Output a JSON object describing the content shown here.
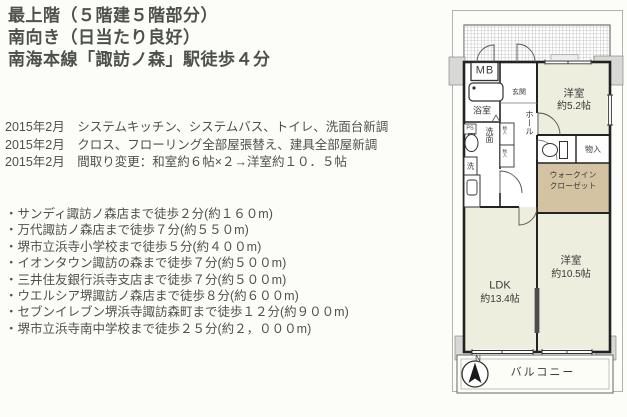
{
  "listing": {
    "headline_lines": [
      "最上階（５階建５階部分）",
      "南向き（日当たり良好）",
      "南海本線「諏訪ノ森」駅徒歩４分"
    ],
    "renovation_lines": [
      "2015年2月　システムキッチン、システムバス、トイレ、洗面台新調",
      "2015年2月　クロス、フローリング全部屋張替え、建具全部屋新調",
      "2015年2月　間取り変更：和室約６帖×２→洋室約１０．５帖"
    ],
    "nearby_lines": [
      "・サンディ諏訪ノ森店まで徒歩２分(約１６０m)",
      "・万代諏訪ノ森店まで徒歩７分(約５５０m)",
      "・堺市立浜寺小学校まで徒歩５分(約４００m)",
      "・イオンタウン諏訪の森まで徒歩７分(約５００m)",
      "・三井住友銀行浜寺支店まで徒歩７分(約５００m)",
      "・ウエルシア堺諏訪ノ森店まで徒歩８分(約６００m)",
      "・セブンイレブン堺浜寺諏訪森町まで徒歩１２分(約９００m)",
      "・堺市立浜寺南中学校まで徒歩２５分(約２，０００m)"
    ]
  },
  "floorplan": {
    "meter_box": "MB",
    "bathroom": "浴室",
    "pipe_space": "PS",
    "washroom": "洗面",
    "laundry": "洗",
    "entrance": "玄関",
    "hall": "ホール",
    "storage_small_top": "物入",
    "storage_small_bottom": "物入",
    "bedroom1_name": "洋室",
    "bedroom1_size": "約5.2帖",
    "storage": "物入",
    "wic_line1": "ウォークイン",
    "wic_line2": "クローゼット",
    "bedroom2_name": "洋室",
    "bedroom2_size": "約10.5帖",
    "ldk_name": "LDK",
    "ldk_size": "約13.4帖",
    "balcony": "バルコニー",
    "north": "N"
  },
  "colors": {
    "room_fill": "#edeedd",
    "closet_fill": "#d3c3a2",
    "pillar_fill": "#d8d8d6",
    "wall": "#2b2b2b",
    "text": "#4d514b"
  }
}
